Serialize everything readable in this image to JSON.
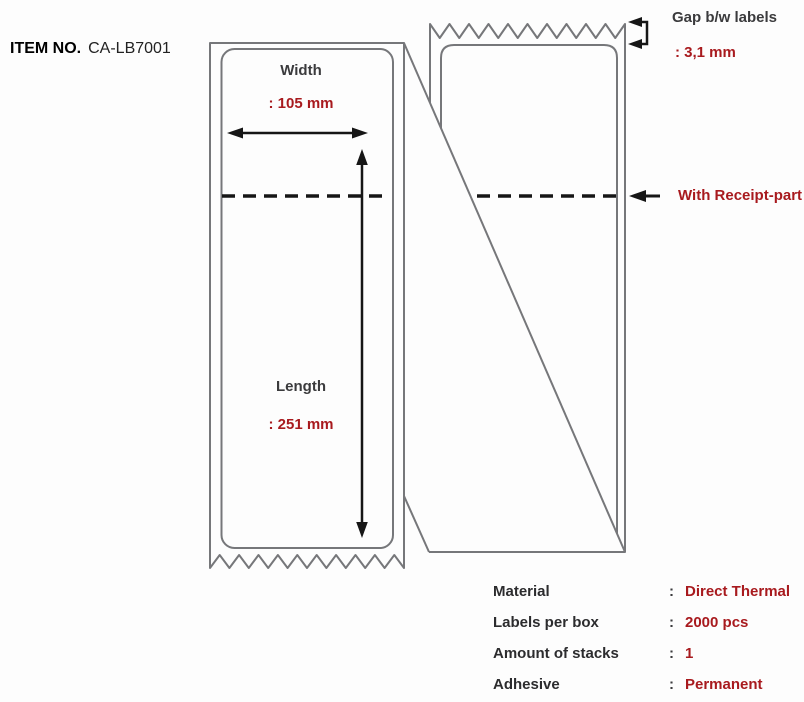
{
  "item": {
    "label": "ITEM NO.",
    "value": "CA-LB7001"
  },
  "label_diagram": {
    "width": {
      "label": "Width",
      "value": ": 105 mm"
    },
    "length": {
      "label": "Length",
      "value": ": 251 mm"
    },
    "gap": {
      "label": "Gap b/w labels",
      "value": ": 3,1 mm"
    },
    "receipt": {
      "label": "With Receipt-part"
    }
  },
  "spec_table": {
    "separator": ":",
    "rows": [
      {
        "label": "Material",
        "value": "Direct Thermal"
      },
      {
        "label": "Labels per box",
        "value": "2000 pcs"
      },
      {
        "label": "Amount of stacks",
        "value": "1"
      },
      {
        "label": "Adhesive",
        "value": "Permanent"
      }
    ]
  },
  "colors": {
    "accent_red": "#a81a1e",
    "line_gray": "#76777a",
    "line_black": "#161616",
    "text_dark": "#3b3b3d"
  }
}
